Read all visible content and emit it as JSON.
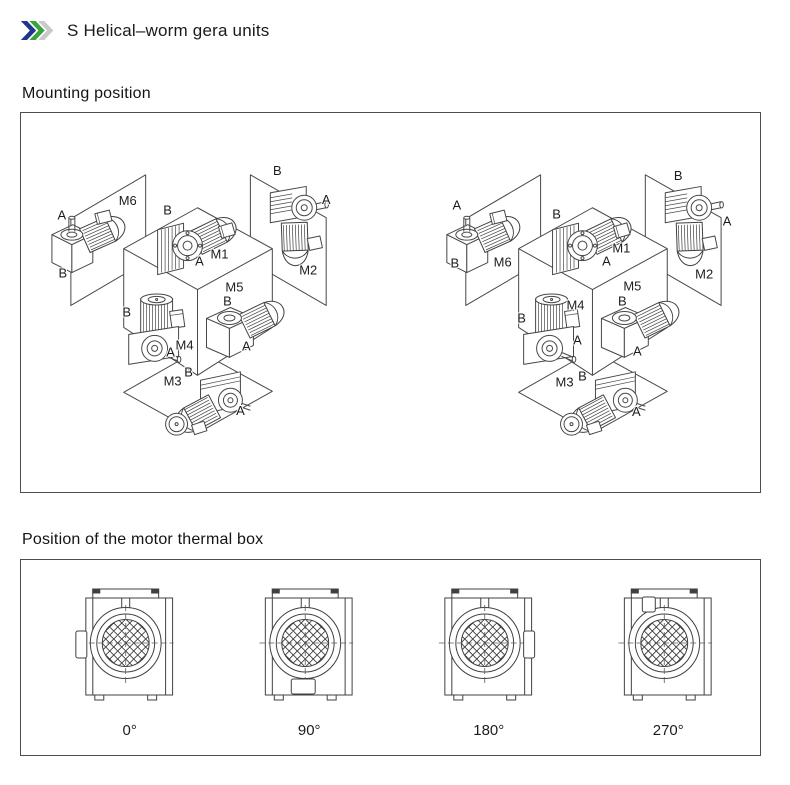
{
  "header": {
    "title": "S Helical–worm gera units",
    "chevron_colors": [
      "#20368c",
      "#3aa339",
      "#c7c9cb"
    ]
  },
  "mounting": {
    "heading": "Mounting position",
    "labels": {
      "left": [
        {
          "t": "A",
          "x": 41,
          "y": 107
        },
        {
          "t": "M6",
          "x": 107,
          "y": 92
        },
        {
          "t": "B",
          "x": 42,
          "y": 165
        },
        {
          "t": "B",
          "x": 147,
          "y": 102
        },
        {
          "t": "M1",
          "x": 199,
          "y": 146
        },
        {
          "t": "A",
          "x": 179,
          "y": 153
        },
        {
          "t": "B",
          "x": 257,
          "y": 62
        },
        {
          "t": "A",
          "x": 306,
          "y": 91
        },
        {
          "t": "M2",
          "x": 288,
          "y": 162
        },
        {
          "t": "B",
          "x": 106,
          "y": 204
        },
        {
          "t": "M4",
          "x": 164,
          "y": 237
        },
        {
          "t": "A",
          "x": 150,
          "y": 244
        },
        {
          "t": "M5",
          "x": 214,
          "y": 179
        },
        {
          "t": "B",
          "x": 207,
          "y": 193
        },
        {
          "t": "A",
          "x": 226,
          "y": 238
        },
        {
          "t": "M3",
          "x": 152,
          "y": 273
        },
        {
          "t": "B",
          "x": 168,
          "y": 264
        },
        {
          "t": "A",
          "x": 220,
          "y": 303
        }
      ],
      "right": [
        {
          "t": "A",
          "x": 437,
          "y": 97
        },
        {
          "t": "B",
          "x": 435,
          "y": 155
        },
        {
          "t": "M6",
          "x": 483,
          "y": 154
        },
        {
          "t": "B",
          "x": 537,
          "y": 106
        },
        {
          "t": "M1",
          "x": 602,
          "y": 140
        },
        {
          "t": "A",
          "x": 587,
          "y": 153
        },
        {
          "t": "B",
          "x": 659,
          "y": 67
        },
        {
          "t": "A",
          "x": 708,
          "y": 113
        },
        {
          "t": "M2",
          "x": 685,
          "y": 166
        },
        {
          "t": "M4",
          "x": 556,
          "y": 197
        },
        {
          "t": "B",
          "x": 502,
          "y": 210
        },
        {
          "t": "A",
          "x": 558,
          "y": 232
        },
        {
          "t": "M5",
          "x": 613,
          "y": 178
        },
        {
          "t": "B",
          "x": 603,
          "y": 193
        },
        {
          "t": "A",
          "x": 618,
          "y": 243
        },
        {
          "t": "M3",
          "x": 545,
          "y": 274
        },
        {
          "t": "B",
          "x": 563,
          "y": 268
        },
        {
          "t": "A",
          "x": 617,
          "y": 304
        }
      ]
    }
  },
  "thermal": {
    "heading": "Position of the motor thermal box",
    "positions": [
      {
        "label": "0°",
        "box_side": "left"
      },
      {
        "label": "90°",
        "box_side": "bottom"
      },
      {
        "label": "180°",
        "box_side": "right"
      },
      {
        "label": "270°",
        "box_side": "top"
      }
    ]
  }
}
